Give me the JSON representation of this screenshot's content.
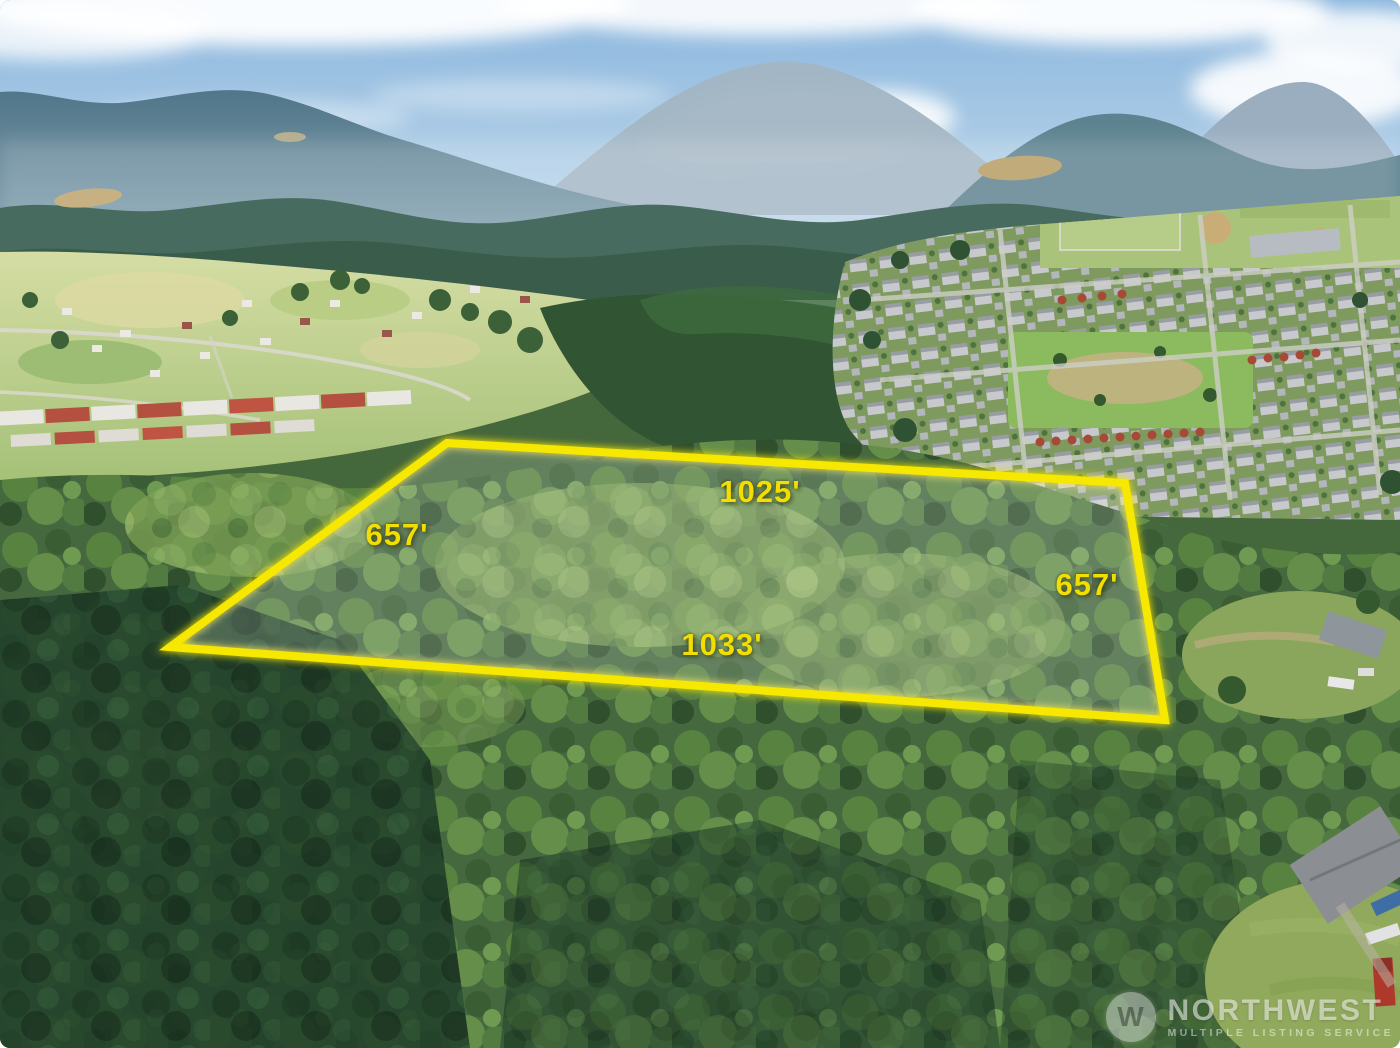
{
  "overlay": {
    "outline_color": "#f2e300",
    "label_color": "#f2de00",
    "labels": {
      "top": "1025'",
      "left": "657'",
      "right": "657'",
      "bottom": "1033'"
    }
  },
  "watermark": {
    "brand": "NORTHWEST",
    "subtitle": "MULTIPLE LISTING SERVICE",
    "logo_monogram": "W"
  },
  "scene": {
    "sky_color": "#8ab6de",
    "mountain_color": "#5d8290",
    "field_color": "#b9cf8c",
    "forest_color": "#45683e",
    "description": "Aerial drone photo of a wooded parcel outlined in yellow, bordered by rural pastures, a suburban neighborhood and hazy mountain backdrop"
  }
}
